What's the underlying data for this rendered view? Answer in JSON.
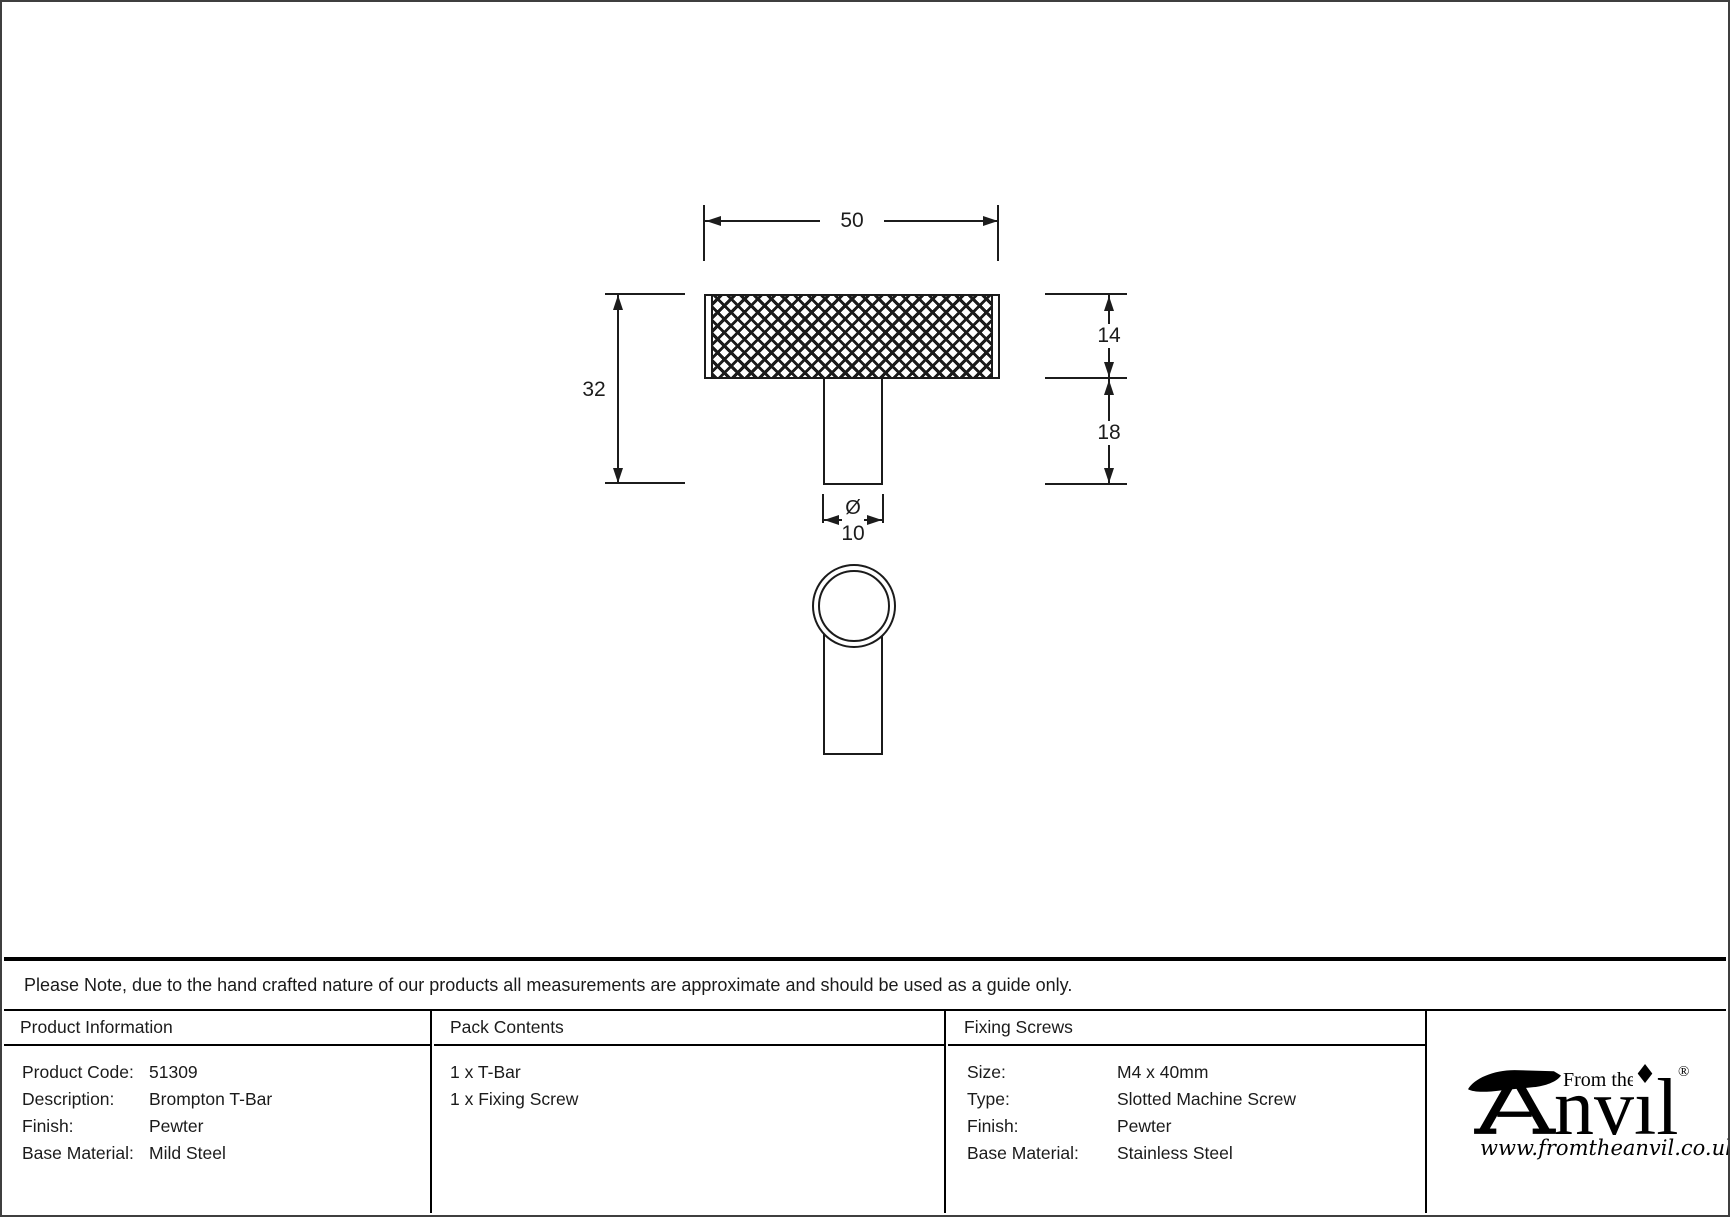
{
  "drawing": {
    "dimensions": {
      "width": "50",
      "overall_height": "32",
      "head_height": "14",
      "stem_height": "18",
      "diameter_symbol": "Ø",
      "diameter": "10"
    }
  },
  "note": "Please Note, due to the hand crafted nature of our products all measurements are approximate and should be used as a guide only.",
  "product_information": {
    "header": "Product Information",
    "rows": [
      {
        "label": "Product Code:",
        "value": "51309"
      },
      {
        "label": "Description:",
        "value": "Brompton T-Bar"
      },
      {
        "label": "Finish:",
        "value": "Pewter"
      },
      {
        "label": "Base Material:",
        "value": "Mild Steel"
      }
    ]
  },
  "pack_contents": {
    "header": "Pack Contents",
    "items": [
      "1 x T-Bar",
      "1 x Fixing Screw"
    ]
  },
  "fixing_screws": {
    "header": "Fixing Screws",
    "rows": [
      {
        "label": "Size:",
        "value": "M4 x 40mm"
      },
      {
        "label": "Type:",
        "value": "Slotted Machine Screw"
      },
      {
        "label": "Finish:",
        "value": "Pewter"
      },
      {
        "label": "Base Material:",
        "value": "Stainless Steel"
      }
    ]
  },
  "logo": {
    "prefix": "From the",
    "brand_text": "nvil",
    "tittle": "♦",
    "registered": "®",
    "website": "www.fromtheanvil.co.uk"
  },
  "colors": {
    "line": "#1b1b1b",
    "border": "#000000",
    "background": "#ffffff"
  }
}
